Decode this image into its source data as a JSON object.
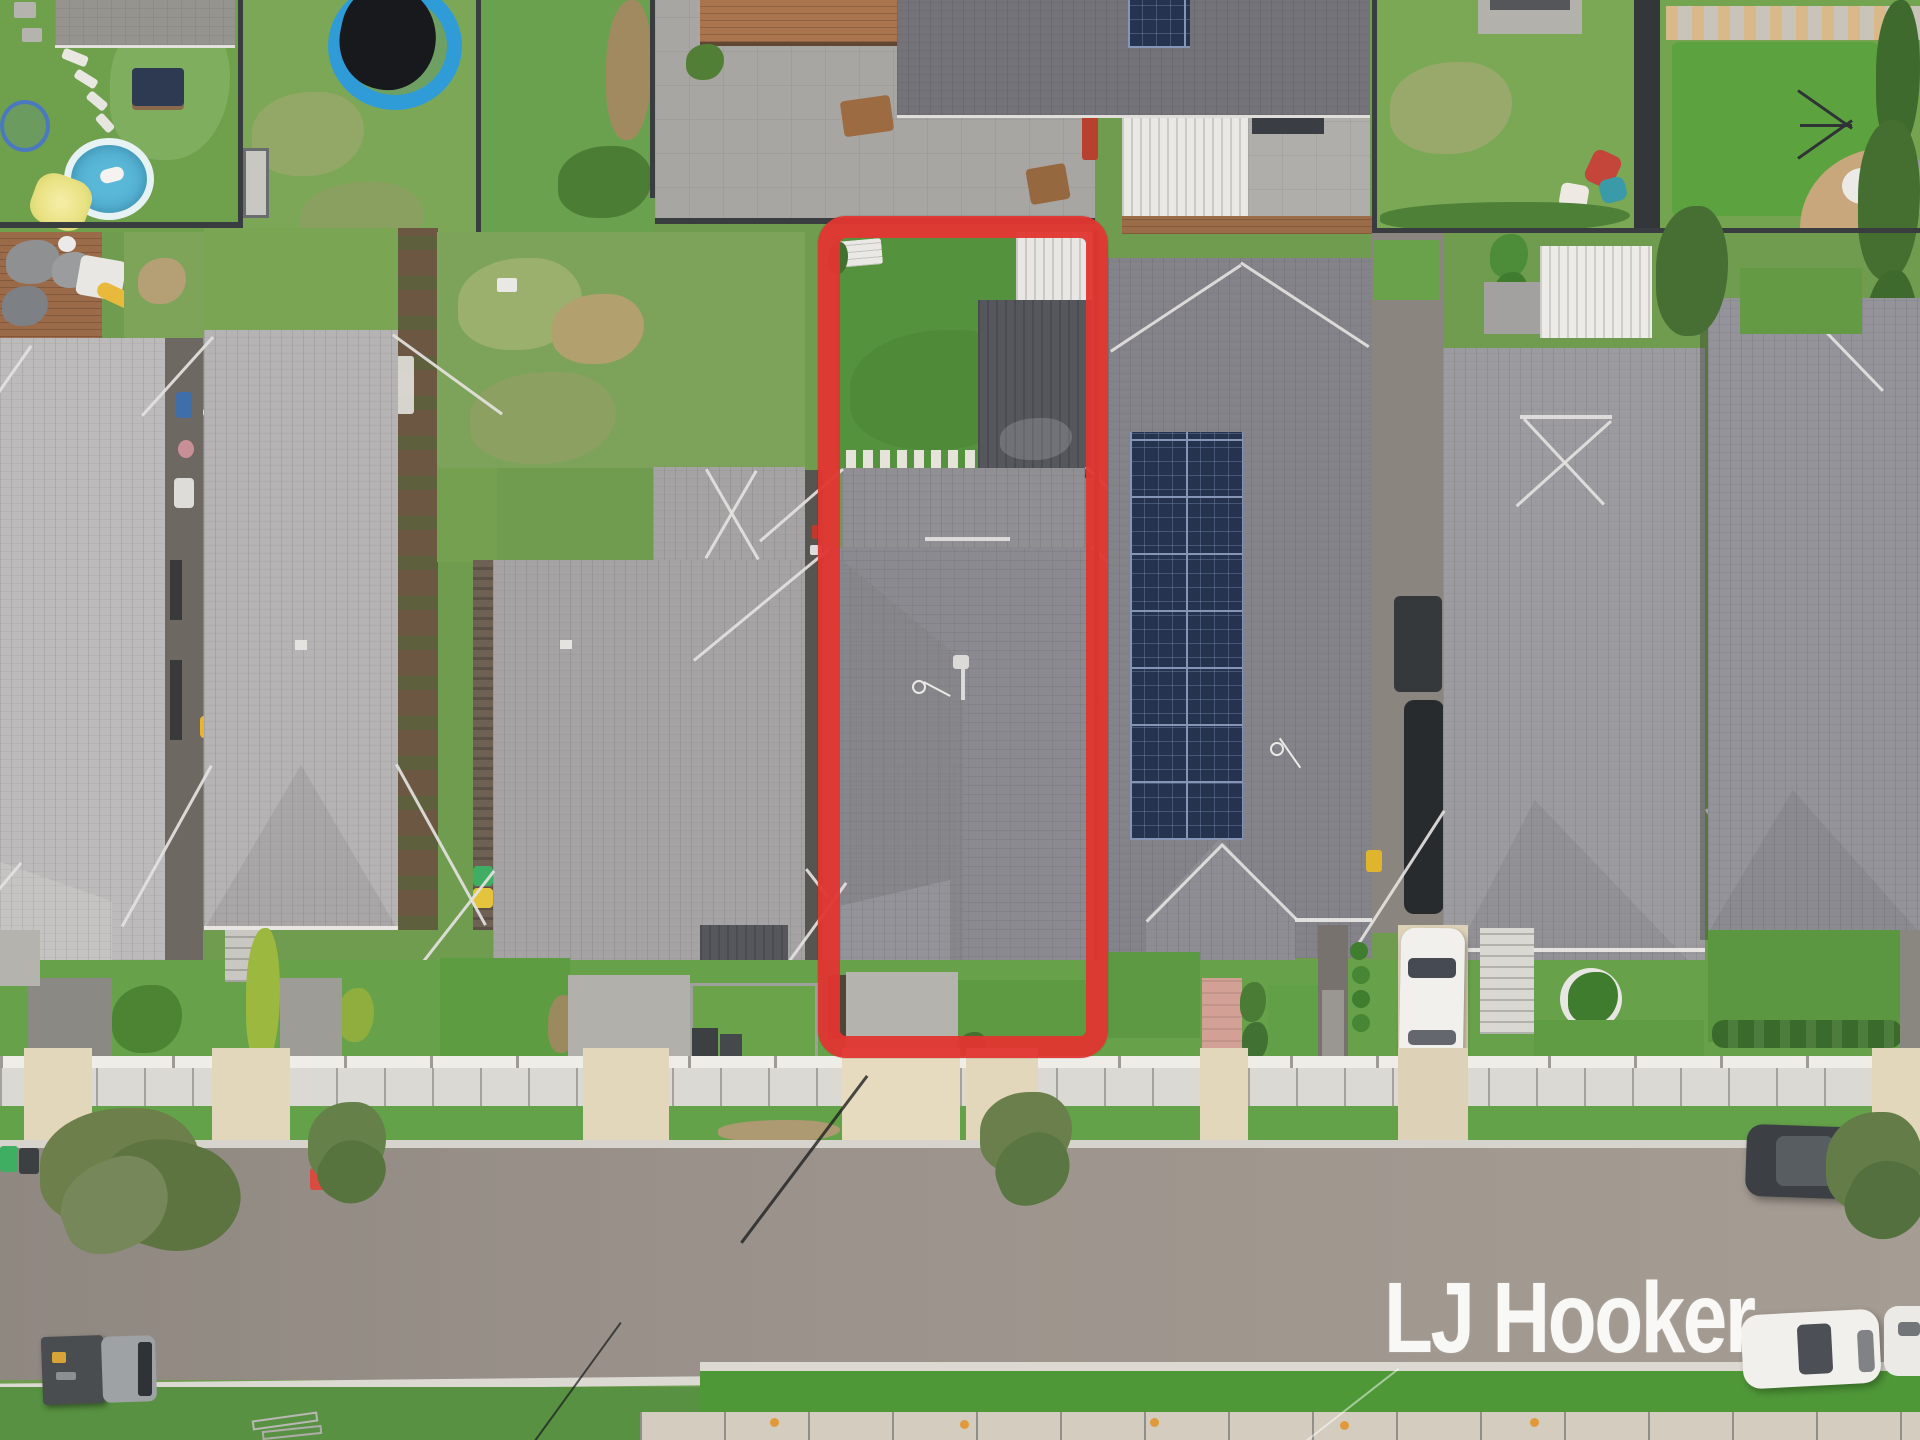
{
  "image_type": "aerial-real-estate-photograph",
  "watermark": {
    "text": "LJ Hooker"
  },
  "highlight": {
    "label": "property boundary outline",
    "color": "#e23531"
  },
  "scene": {
    "description": "Top-down drone photo of a row of suburban houses with grey tiled hip roofs; fenced backyards at top (trampoline, kiddie pool, yellow umbrella, paved patio, timber decks), the listed lot outlined in red containing a lawn, dark metal shed and tiled roof; solar panel array on the neighbouring roof; white front fence, concrete footpath, grass verge and asphalt street at bottom with street trees, wheelie bins, parked cars, a flatbed truck and an LJ Hooker watermark."
  },
  "palette": {
    "grass-base": "#6f9c4e",
    "grass-bright": "#55923d",
    "grass-verge": "#64a24a",
    "grass-olive": "#93a866",
    "grass-patchy": "#7da35a",
    "dirt": "#ab9468",
    "roof-light": "#bcbabb",
    "roof-mid": "#a5a3a4",
    "roof-mid2": "#8b8a90",
    "roof-dark": "#84838a",
    "roof-back": "#74737a",
    "shed-dark": "#56575d",
    "fence": "#3a3d3f",
    "paver": "#a8a6a3",
    "deck": "#a9744e",
    "concrete": "#b5b3ae",
    "beige": "#e2d6bb",
    "footpath": "#dbd9d3",
    "street": "#9c948c",
    "curb": "#dcd9d2",
    "solar": "#26334f",
    "solar-grid": "#8495b5",
    "pool": "#59b7d8",
    "tramp": "#2f9cd8",
    "umbrella": "#e9e283",
    "red": "#e23531",
    "white": "#f1f0ed",
    "car-dark": "#3c4045",
    "mulch": "#5a4a3a",
    "hedge": "#4d8434",
    "watermark": "rgba(252,252,250,0.95)"
  }
}
